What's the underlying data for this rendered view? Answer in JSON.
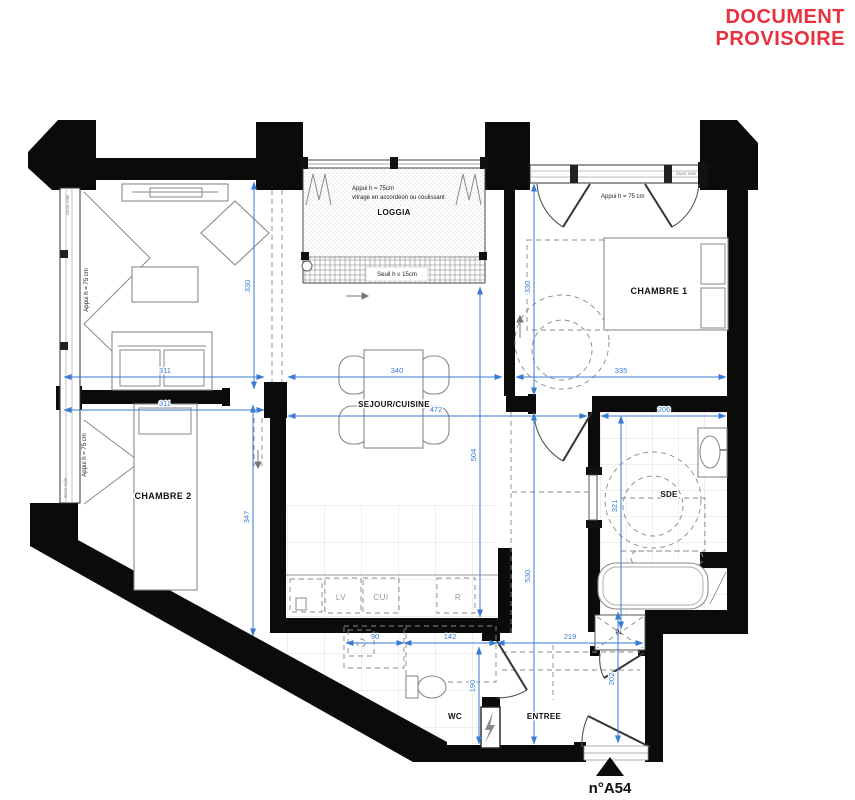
{
  "header": {
    "line1": "DOCUMENT",
    "line2": "PROVISOIRE"
  },
  "unit_label": "n°A54",
  "rooms": {
    "loggia": "LOGGIA",
    "chambre1": "CHAMBRE 1",
    "chambre2": "CHAMBRE 2",
    "sejour": "SEJOUR/CUISINE",
    "sde": "SDE",
    "wc": "WC",
    "entree": "ENTREE",
    "placard": "PL"
  },
  "kitchen": {
    "lv": "LV",
    "cui": "CUI",
    "r": "R"
  },
  "annotations": {
    "appui_loggia": "Appui h = 75cm",
    "vitrage": "vitrage en accordéon ou coulissant",
    "seuil": "Seuil h ≤ 15cm",
    "appui_ch1": "Appui h = 75 cm",
    "appui_sejour": "Appui h = 75 cm",
    "appui_ch2": "Appui h = 75 cm",
    "store_left_sejour": "Store toile",
    "store_left_ch2": "Store toile",
    "store_ch1": "Store toile"
  },
  "dimensions": {
    "sejour_width": "311",
    "cuisine_width": "340",
    "chambre1_width": "335",
    "chambre2_width": "311",
    "sejour_total_width": "472",
    "sde_width": "206",
    "sejour_height": "330",
    "chambre1_height": "330",
    "chambre2_height": "347",
    "sejour_depth": "504",
    "corridor_height": "530",
    "sde_height": "321",
    "wc_width_1": "90",
    "wc_width_2": "142",
    "entree_width": "219",
    "wc_height": "190",
    "entree_height": "202"
  },
  "colors": {
    "provisional_red": "#E6313F",
    "dimension_blue": "#3A7BD5",
    "wall_black": "#0B0B0B"
  }
}
